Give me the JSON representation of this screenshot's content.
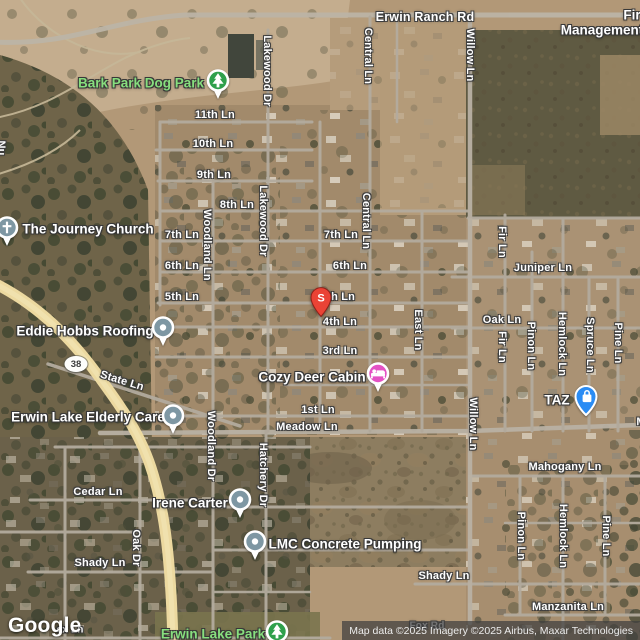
{
  "attribution": "Map data ©2025 Imagery ©2025 Airbus, Maxar Technologies",
  "google_logo": "Google",
  "highway_shield": {
    "text": "38",
    "x": 76,
    "y": 364
  },
  "selected_marker": {
    "label": "S",
    "x": 321,
    "y": 300,
    "color": "#EA4335"
  },
  "colors": {
    "park_text": "#87DE7E",
    "road": "#B3AB9E",
    "highway": "#ECD9A0",
    "poi_generic_pin": "#7E97A3",
    "lodging_pin": "#E452C4",
    "shopping_pin": "#2A8CF4",
    "park_pin": "#2FA04C"
  },
  "street_labels": [
    {
      "text": "Erwin Ranch Rd",
      "x": 425,
      "y": 17,
      "orient": "h",
      "size": "major"
    },
    {
      "text": "11th Ln",
      "x": 215,
      "y": 115,
      "orient": "h"
    },
    {
      "text": "10th Ln",
      "x": 213,
      "y": 144,
      "orient": "h"
    },
    {
      "text": "9th Ln",
      "x": 214,
      "y": 175,
      "orient": "h"
    },
    {
      "text": "8th Ln",
      "x": 237,
      "y": 205,
      "orient": "h"
    },
    {
      "text": "7th Ln",
      "x": 182,
      "y": 235,
      "orient": "h"
    },
    {
      "text": "6th Ln",
      "x": 182,
      "y": 266,
      "orient": "h"
    },
    {
      "text": "5th Ln",
      "x": 182,
      "y": 297,
      "orient": "h"
    },
    {
      "text": "7th Ln",
      "x": 341,
      "y": 235,
      "orient": "h"
    },
    {
      "text": "6th Ln",
      "x": 350,
      "y": 266,
      "orient": "h"
    },
    {
      "text": "5th Ln",
      "x": 338,
      "y": 297,
      "orient": "h"
    },
    {
      "text": "4th Ln",
      "x": 340,
      "y": 322,
      "orient": "h"
    },
    {
      "text": "3rd Ln",
      "x": 340,
      "y": 351,
      "orient": "h"
    },
    {
      "text": "1st Ln",
      "x": 318,
      "y": 410,
      "orient": "h"
    },
    {
      "text": "Meadow Ln",
      "x": 307,
      "y": 427,
      "orient": "h"
    },
    {
      "text": "State Ln",
      "x": 122,
      "y": 381,
      "orient": "h",
      "angle": 17
    },
    {
      "text": "Juniper Ln",
      "x": 543,
      "y": 268,
      "orient": "h"
    },
    {
      "text": "Oak Ln",
      "x": 502,
      "y": 320,
      "orient": "h"
    },
    {
      "text": "Mahogany Ln",
      "x": 565,
      "y": 467,
      "orient": "h"
    },
    {
      "text": "Cedar Ln",
      "x": 98,
      "y": 492,
      "orient": "h"
    },
    {
      "text": "Shady Ln",
      "x": 100,
      "y": 563,
      "orient": "h"
    },
    {
      "text": "Shady Ln",
      "x": 444,
      "y": 576,
      "orient": "h"
    },
    {
      "text": "Manzanita Ln",
      "x": 568,
      "y": 607,
      "orient": "h"
    },
    {
      "text": "ex Ln",
      "x": 70,
      "y": 630,
      "orient": "h",
      "size": "small"
    },
    {
      "text": "Fox Rd",
      "x": 427,
      "y": 626,
      "orient": "h",
      "size": "small",
      "under": true
    },
    {
      "text": "M",
      "x": 641,
      "y": 422,
      "orient": "h"
    },
    {
      "text": "Lakewood Dr",
      "x": 267,
      "y": 71,
      "orient": "v"
    },
    {
      "text": "Lakewood Dr",
      "x": 263,
      "y": 221,
      "orient": "v"
    },
    {
      "text": "Central Ln",
      "x": 368,
      "y": 56,
      "orient": "v"
    },
    {
      "text": "Central Ln",
      "x": 366,
      "y": 221,
      "orient": "v"
    },
    {
      "text": "Willow Ln",
      "x": 470,
      "y": 55,
      "orient": "v"
    },
    {
      "text": "Willow Ln",
      "x": 473,
      "y": 424,
      "orient": "v"
    },
    {
      "text": "Woodland Ln",
      "x": 207,
      "y": 245,
      "orient": "v"
    },
    {
      "text": "Woodland Dr",
      "x": 211,
      "y": 446,
      "orient": "v"
    },
    {
      "text": "East Ln",
      "x": 418,
      "y": 330,
      "orient": "v"
    },
    {
      "text": "Hatchery Dr",
      "x": 263,
      "y": 475,
      "orient": "v"
    },
    {
      "text": "Oak Dr",
      "x": 136,
      "y": 548,
      "orient": "v"
    },
    {
      "text": "Fir Ln",
      "x": 502,
      "y": 242,
      "orient": "v"
    },
    {
      "text": "Fir Ln",
      "x": 502,
      "y": 347,
      "orient": "v"
    },
    {
      "text": "Pinon Ln",
      "x": 531,
      "y": 346,
      "orient": "v"
    },
    {
      "text": "Hemlock Ln",
      "x": 562,
      "y": 344,
      "orient": "v"
    },
    {
      "text": "Spruce Ln",
      "x": 590,
      "y": 345,
      "orient": "v"
    },
    {
      "text": "Pine Ln",
      "x": 618,
      "y": 343,
      "orient": "v"
    },
    {
      "text": "Pinon Ln",
      "x": 521,
      "y": 536,
      "orient": "v"
    },
    {
      "text": "Hemlock Ln",
      "x": 563,
      "y": 536,
      "orient": "v"
    },
    {
      "text": "Pine Ln",
      "x": 606,
      "y": 536,
      "orient": "v"
    },
    {
      "text": "Nu",
      "x": 1,
      "y": 148,
      "orient": "v"
    }
  ],
  "poi_labels": [
    {
      "text": "Bark Park Dog Park",
      "x": 141,
      "y": 83,
      "color": "green",
      "marker": {
        "icon": "tree-icon",
        "pin": "circle",
        "color": "#2FA04C",
        "x": 218,
        "y": 81
      }
    },
    {
      "text": "The Journey Church",
      "x": 88,
      "y": 229,
      "color": "white",
      "marker": {
        "icon": "cross-icon",
        "pin": "circle",
        "color": "#7E97A3",
        "x": 7,
        "y": 228
      }
    },
    {
      "text": "Eddie Hobbs Roofing",
      "x": 85,
      "y": 331,
      "color": "white",
      "marker": {
        "icon": "dot-icon",
        "pin": "circle",
        "color": "#7E97A3",
        "x": 163,
        "y": 328
      }
    },
    {
      "text": "Erwin Lake Elderly Care",
      "x": 88,
      "y": 417,
      "color": "white",
      "marker": {
        "icon": "dot-icon",
        "pin": "circle",
        "color": "#7E97A3",
        "x": 173,
        "y": 416
      }
    },
    {
      "text": "Cozy Deer Cabin",
      "x": 312,
      "y": 377,
      "color": "white",
      "marker": {
        "icon": "bed-icon",
        "pin": "circle",
        "color": "#E452C4",
        "x": 378,
        "y": 374
      }
    },
    {
      "text": "Irene Carter",
      "x": 190,
      "y": 503,
      "color": "white",
      "marker": {
        "icon": "dot-icon",
        "pin": "circle",
        "color": "#7E97A3",
        "x": 240,
        "y": 500
      }
    },
    {
      "text": "LMC Concrete Pumping",
      "x": 345,
      "y": 544,
      "color": "white",
      "marker": {
        "icon": "dot-icon",
        "pin": "circle",
        "color": "#7E97A3",
        "x": 255,
        "y": 542
      }
    },
    {
      "text": "TAZ",
      "x": 557,
      "y": 400,
      "color": "white",
      "marker": {
        "icon": "bag-icon",
        "pin": "teardrop",
        "color": "#2A8CF4",
        "x": 585,
        "y": 396
      }
    },
    {
      "text": "Erwin Lake Park",
      "x": 213,
      "y": 634,
      "color": "green",
      "marker": {
        "icon": "tree-icon",
        "pin": "circle",
        "color": "#2FA04C",
        "x": 277,
        "y": 632
      }
    },
    {
      "text": "Fir",
      "x": 632,
      "y": 15,
      "color": "white"
    },
    {
      "text": "Management",
      "x": 602,
      "y": 30,
      "color": "white"
    }
  ]
}
